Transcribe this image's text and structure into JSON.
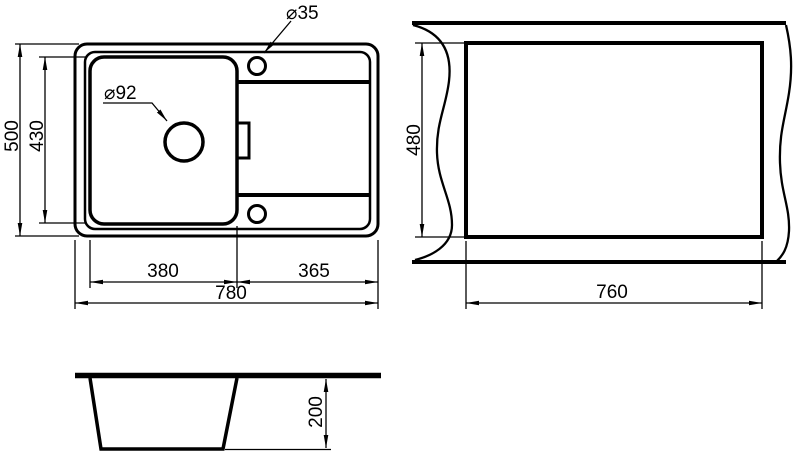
{
  "drawing": {
    "plan_view": {
      "drain_hole_label": "⌀92",
      "tap_hole_label": "⌀35",
      "dim_overall_height": "500",
      "dim_bowl_height": "430",
      "dim_bowl_width": "380",
      "dim_drainer_width": "365",
      "dim_overall_width": "780"
    },
    "cutout_view": {
      "dim_cutout_height": "480",
      "dim_cutout_width": "760"
    },
    "section_view": {
      "dim_bowl_depth": "200"
    },
    "colors": {
      "line": "#000000",
      "background": "#ffffff"
    }
  }
}
